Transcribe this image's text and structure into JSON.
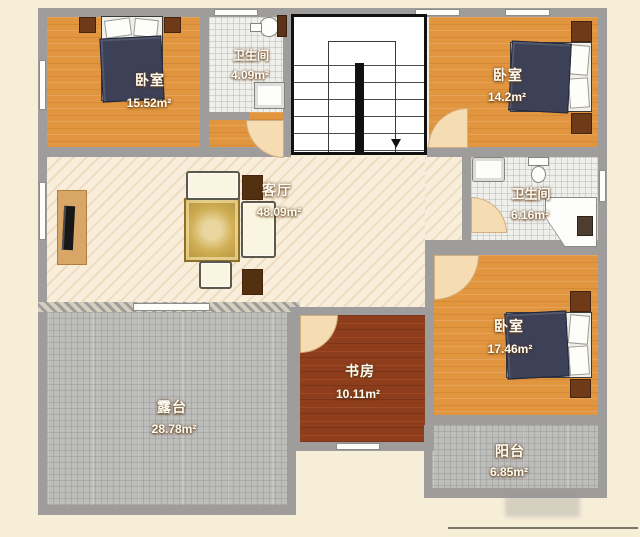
{
  "floorplan": {
    "title": "residential floor plan",
    "rooms": {
      "bedroom_top_left": {
        "name": "卧室",
        "area": "15.52m²"
      },
      "bathroom_top": {
        "name": "卫生间",
        "area": "4.09m²"
      },
      "bedroom_top_right": {
        "name": "卧室",
        "area": "14.2m²"
      },
      "living_room": {
        "name": "客厅",
        "area": "48.09m²"
      },
      "bathroom_right": {
        "name": "卫生间",
        "area": "6.16m²"
      },
      "bedroom_bottom_right": {
        "name": "卧室",
        "area": "17.46m²"
      },
      "study": {
        "name": "书房",
        "area": "10.11m²"
      },
      "terrace": {
        "name": "露台",
        "area": "28.78m²"
      },
      "balcony": {
        "name": "阳台",
        "area": "6.85m²"
      }
    },
    "colors": {
      "background": "#f7eed8",
      "wall": "#9e9d9b",
      "wood_floor": "#e2953f",
      "living_floor": "#f8eedb",
      "study_floor": "#8e3d1d",
      "terrace_tile": "#bdbdbb",
      "bath_tile": "#efefec",
      "stair_outline": "#111111",
      "bed_blanket": "#3c4157",
      "furniture_brown": "#6e3a17",
      "door_arc": "#f6dcb2"
    }
  }
}
